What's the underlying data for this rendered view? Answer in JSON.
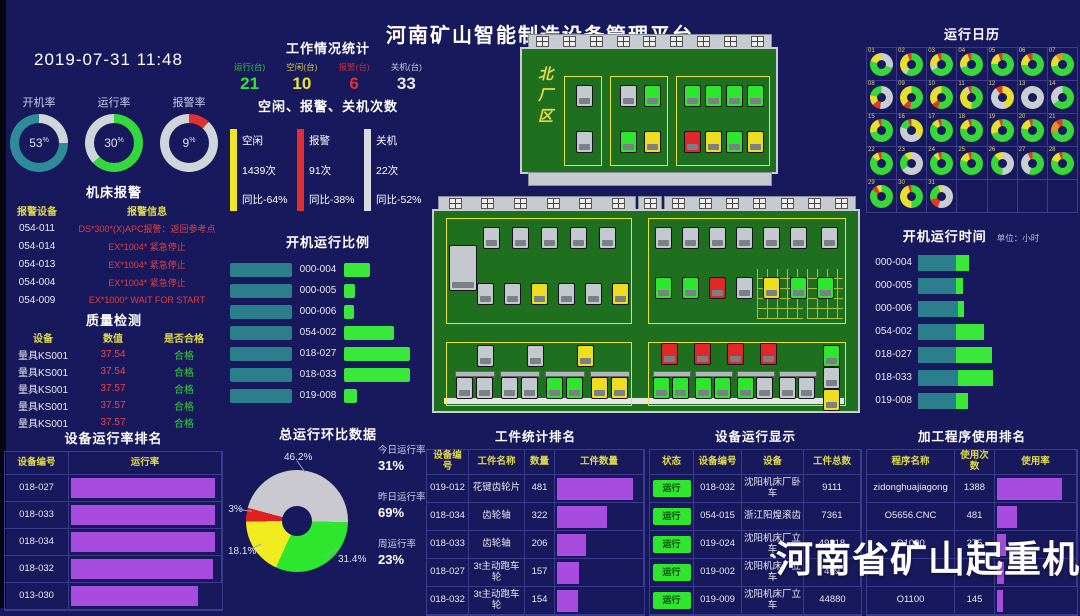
{
  "title": "河南矿山智能制造设备管理平台",
  "datetime": "2019-07-31 11:48",
  "gauges": {
    "items": [
      {
        "label": "开机率",
        "value": "53",
        "unit": "%",
        "c1": "#cfd6da",
        "p1": 25,
        "c2": "#2d8c98"
      },
      {
        "label": "运行率",
        "value": "30",
        "unit": "%",
        "c1": "#35d83c",
        "p1": 63,
        "c2": "#cfd6da"
      },
      {
        "label": "报警率",
        "value": "9",
        "unit": "%",
        "c1": "#e03030",
        "p1": 12,
        "c2": "#cfd6da"
      }
    ]
  },
  "alarm": {
    "title": "机床报警",
    "headers": [
      "报警设备",
      "报警信息"
    ],
    "rows": [
      {
        "dev": "054-011",
        "msg": "DS*300*(X)APC报警：返回参考点"
      },
      {
        "dev": "054-014",
        "msg": "EX*1004* 紧急停止"
      },
      {
        "dev": "054-013",
        "msg": "EX*1004* 紧急停止"
      },
      {
        "dev": "054-004",
        "msg": "EX*1004* 紧急停止"
      },
      {
        "dev": "054-009",
        "msg": "EX*1000* WAIT FOR START"
      }
    ]
  },
  "quality": {
    "title": "质量检测",
    "headers": [
      "设备",
      "数值",
      "是否合格"
    ],
    "rows": [
      {
        "dev": "量具KS001",
        "val": "37.54",
        "ok": "合格"
      },
      {
        "dev": "量具KS001",
        "val": "37.54",
        "ok": "合格"
      },
      {
        "dev": "量具KS001",
        "val": "37.57",
        "ok": "合格"
      },
      {
        "dev": "量具KS001",
        "val": "37.57",
        "ok": "合格"
      },
      {
        "dev": "量具KS001",
        "val": "37.57",
        "ok": "合格"
      }
    ]
  },
  "rank": {
    "title": "设备运行率排名",
    "headers": [
      "设备编号",
      "运行率"
    ],
    "rows": [
      {
        "id": "018-027",
        "pct": 97
      },
      {
        "id": "018-033",
        "pct": 97
      },
      {
        "id": "018-034",
        "pct": 97
      },
      {
        "id": "018-032",
        "pct": 96
      },
      {
        "id": "013-030",
        "pct": 85
      }
    ]
  },
  "workstats": {
    "title": "工作情况统计",
    "items": [
      {
        "label": "运行(台)",
        "value": "21",
        "color": "#2fe32f"
      },
      {
        "label": "空闲(台)",
        "value": "10",
        "color": "#ece23a"
      },
      {
        "label": "报警(台)",
        "value": "6",
        "color": "#e03030"
      },
      {
        "label": "关机(台)",
        "value": "33",
        "color": "#e8e8f0"
      }
    ]
  },
  "counts": {
    "title": "空闲、报警、关机次数",
    "items": [
      {
        "label": "空闲",
        "count": "1439次",
        "yoy": "同比-64%",
        "color": "#f0e626"
      },
      {
        "label": "报警",
        "count": "91次",
        "yoy": "同比-38%",
        "color": "#e03030"
      },
      {
        "label": "关机",
        "count": "22次",
        "yoy": "同比-52%",
        "color": "#d8dce2"
      }
    ]
  },
  "ratio": {
    "title": "开机运行比例",
    "rows": [
      {
        "id": "000-004",
        "green": 26
      },
      {
        "id": "000-005",
        "green": 11
      },
      {
        "id": "000-006",
        "green": 10
      },
      {
        "id": "054-002",
        "green": 50
      },
      {
        "id": "018-027",
        "green": 66
      },
      {
        "id": "018-033",
        "green": 66
      },
      {
        "id": "019-008",
        "green": 13
      }
    ]
  },
  "pie": {
    "title": "总运行环比数据",
    "slices": [
      {
        "label": "46.2%",
        "pct": 46.2,
        "color": "#c9c9cf"
      },
      {
        "label": "31.4%",
        "pct": 31.4,
        "color": "#2ee62e"
      },
      {
        "label": "18.1%",
        "pct": 18.1,
        "color": "#f0ec20"
      },
      {
        "label": "4.3%",
        "pct": 4.3,
        "color": "#e02020"
      }
    ],
    "side": [
      {
        "label": "今日运行率",
        "value": "31%"
      },
      {
        "label": "昨日运行率",
        "value": "69%"
      },
      {
        "label": "周运行率",
        "value": "23%"
      }
    ]
  },
  "factory": {
    "status_colors": {
      "g": "#c3c9cf",
      "G": "#2ee62e",
      "Y": "#f0dc20",
      "R": "#e02828"
    },
    "north": {
      "label": "北厂区",
      "zones": [
        {
          "x": 44,
          "y": 42,
          "w": 36,
          "h": 88,
          "cols": 1,
          "m": [
            "g",
            "g"
          ]
        },
        {
          "x": 90,
          "y": 42,
          "w": 56,
          "h": 88,
          "cols": 2,
          "m": [
            "g",
            "G",
            "G",
            "Y"
          ]
        },
        {
          "x": 156,
          "y": 42,
          "w": 92,
          "h": 88,
          "cols": 4,
          "m": [
            "G",
            "G",
            "G",
            "G",
            "R",
            "Y",
            "G",
            "Y"
          ]
        }
      ]
    },
    "south": {
      "lt_row1": [
        "g",
        "g",
        "g",
        "g",
        "g"
      ],
      "lt_row2": [
        "g",
        "g",
        "Y",
        "g",
        "g",
        "Y"
      ],
      "rt_row1": [
        "g",
        "g",
        "g",
        "g",
        "g",
        "g"
      ],
      "rt_row2": [
        "G",
        "G",
        "R",
        "g",
        "Y",
        "G",
        "G"
      ],
      "lb_top": [
        "g",
        "g",
        "Y"
      ],
      "lb_st": [
        [
          "g",
          "g"
        ],
        [
          "g",
          "g"
        ],
        [
          "G",
          "G"
        ],
        [
          "Y",
          "Y"
        ]
      ],
      "rb_top": [
        "R",
        "R",
        "R",
        "R"
      ],
      "rb_st": [
        [
          "G",
          "G"
        ],
        [
          "G",
          "G"
        ],
        [
          "G",
          "g"
        ],
        [
          "g",
          "g"
        ]
      ],
      "rb_side": [
        "G",
        "g",
        "Y"
      ]
    }
  },
  "calendar": {
    "title": "运行日历",
    "colors": {
      "G": "#38d838",
      "Y": "#e8de2e",
      "N": "#c9ced3",
      "R": "#e03a22",
      "O": "#e8901e"
    },
    "days": [
      {
        "d": "01",
        "s": [
          [
            "N",
            30
          ],
          [
            "G",
            50
          ],
          [
            "Y",
            20
          ]
        ]
      },
      {
        "d": "02",
        "s": [
          [
            "G",
            58
          ],
          [
            "N",
            6
          ],
          [
            "Y",
            30
          ],
          [
            "R",
            6
          ]
        ]
      },
      {
        "d": "03",
        "s": [
          [
            "G",
            66
          ],
          [
            "N",
            8
          ],
          [
            "Y",
            20
          ],
          [
            "R",
            6
          ]
        ]
      },
      {
        "d": "04",
        "s": [
          [
            "G",
            70
          ],
          [
            "N",
            4
          ],
          [
            "Y",
            20
          ],
          [
            "R",
            6
          ]
        ]
      },
      {
        "d": "05",
        "s": [
          [
            "G",
            76
          ],
          [
            "Y",
            18
          ],
          [
            "R",
            6
          ]
        ]
      },
      {
        "d": "06",
        "s": [
          [
            "G",
            74
          ],
          [
            "Y",
            18
          ],
          [
            "R",
            8
          ]
        ]
      },
      {
        "d": "07",
        "s": [
          [
            "G",
            72
          ],
          [
            "Y",
            18
          ],
          [
            "O",
            10
          ]
        ]
      },
      {
        "d": "08",
        "s": [
          [
            "N",
            52
          ],
          [
            "R",
            12
          ],
          [
            "Y",
            14
          ],
          [
            "G",
            22
          ]
        ]
      },
      {
        "d": "09",
        "s": [
          [
            "G",
            52
          ],
          [
            "R",
            10
          ],
          [
            "Y",
            38
          ]
        ]
      },
      {
        "d": "10",
        "s": [
          [
            "G",
            55
          ],
          [
            "R",
            10
          ],
          [
            "Y",
            35
          ]
        ]
      },
      {
        "d": "11",
        "s": [
          [
            "G",
            50
          ],
          [
            "Y",
            40
          ],
          [
            "N",
            5
          ],
          [
            "R",
            5
          ]
        ]
      },
      {
        "d": "12",
        "s": [
          [
            "Y",
            45
          ],
          [
            "N",
            45
          ],
          [
            "R",
            10
          ]
        ]
      },
      {
        "d": "13",
        "s": [
          [
            "N",
            100
          ]
        ]
      },
      {
        "d": "14",
        "s": [
          [
            "G",
            65
          ],
          [
            "N",
            35
          ]
        ]
      },
      {
        "d": "15",
        "s": [
          [
            "G",
            72
          ],
          [
            "Y",
            23
          ],
          [
            "R",
            5
          ]
        ]
      },
      {
        "d": "16",
        "s": [
          [
            "Y",
            35
          ],
          [
            "N",
            45
          ],
          [
            "G",
            15
          ],
          [
            "R",
            5
          ]
        ]
      },
      {
        "d": "17",
        "s": [
          [
            "G",
            85
          ],
          [
            "Y",
            10
          ],
          [
            "R",
            5
          ]
        ]
      },
      {
        "d": "18",
        "s": [
          [
            "G",
            78
          ],
          [
            "Y",
            17
          ],
          [
            "R",
            5
          ]
        ]
      },
      {
        "d": "19",
        "s": [
          [
            "G",
            70
          ],
          [
            "Y",
            25
          ],
          [
            "R",
            5
          ]
        ]
      },
      {
        "d": "20",
        "s": [
          [
            "G",
            78
          ],
          [
            "Y",
            17
          ],
          [
            "R",
            5
          ]
        ]
      },
      {
        "d": "21",
        "s": [
          [
            "G",
            72
          ],
          [
            "O",
            18
          ],
          [
            "R",
            10
          ]
        ]
      },
      {
        "d": "22",
        "s": [
          [
            "G",
            85
          ],
          [
            "Y",
            10
          ],
          [
            "R",
            5
          ]
        ]
      },
      {
        "d": "23",
        "s": [
          [
            "N",
            65
          ],
          [
            "G",
            25
          ],
          [
            "Y",
            10
          ]
        ]
      },
      {
        "d": "24",
        "s": [
          [
            "G",
            88
          ],
          [
            "Y",
            7
          ],
          [
            "R",
            5
          ]
        ]
      },
      {
        "d": "25",
        "s": [
          [
            "G",
            80
          ],
          [
            "Y",
            15
          ],
          [
            "R",
            5
          ]
        ]
      },
      {
        "d": "26",
        "s": [
          [
            "N",
            50
          ],
          [
            "G",
            38
          ],
          [
            "Y",
            12
          ]
        ]
      },
      {
        "d": "27",
        "s": [
          [
            "G",
            55
          ],
          [
            "N",
            38
          ],
          [
            "R",
            7
          ]
        ]
      },
      {
        "d": "28",
        "s": [
          [
            "G",
            80
          ],
          [
            "Y",
            15
          ],
          [
            "R",
            5
          ]
        ]
      },
      {
        "d": "29",
        "s": [
          [
            "G",
            85
          ],
          [
            "R",
            8
          ],
          [
            "Y",
            7
          ]
        ]
      },
      {
        "d": "30",
        "s": [
          [
            "G",
            50
          ],
          [
            "Y",
            45
          ],
          [
            "R",
            5
          ]
        ]
      },
      {
        "d": "31",
        "s": [
          [
            "N",
            55
          ],
          [
            "R",
            15
          ],
          [
            "G",
            25
          ],
          [
            "Y",
            5
          ]
        ]
      }
    ]
  },
  "runtime": {
    "title": "开机运行时间",
    "unit": "单位：小时",
    "rows": [
      {
        "id": "000-004",
        "teal": 38,
        "green": 13
      },
      {
        "id": "000-005",
        "teal": 38,
        "green": 7
      },
      {
        "id": "000-006",
        "teal": 40,
        "green": 6
      },
      {
        "id": "054-002",
        "teal": 38,
        "green": 28
      },
      {
        "id": "018-027",
        "teal": 38,
        "green": 36
      },
      {
        "id": "018-033",
        "teal": 40,
        "green": 35
      },
      {
        "id": "019-008",
        "teal": 38,
        "green": 12
      }
    ]
  },
  "workpiece": {
    "title": "工件统计排名",
    "headers": [
      "设备编号",
      "工件名称",
      "数量",
      "工件数量"
    ],
    "rows": [
      {
        "id": "019-012",
        "name": "花键齿轮片",
        "qty": "481",
        "pct": 90
      },
      {
        "id": "018-034",
        "name": "齿轮轴",
        "qty": "322",
        "pct": 60
      },
      {
        "id": "018-033",
        "name": "齿轮轴",
        "qty": "206",
        "pct": 35
      },
      {
        "id": "018-027",
        "name": "3t主动跑车轮",
        "qty": "157",
        "pct": 26
      },
      {
        "id": "018-032",
        "name": "3t主动跑车轮",
        "qty": "154",
        "pct": 25
      }
    ]
  },
  "device": {
    "title": "设备运行显示",
    "headers": [
      "状态",
      "设备编号",
      "设备",
      "工件总数"
    ],
    "rows": [
      {
        "status": "运行",
        "id": "018-032",
        "name": "沈阳机床厂卧车",
        "total": "9111"
      },
      {
        "status": "运行",
        "id": "054-015",
        "name": "浙江阳煌滚齿",
        "total": "7361"
      },
      {
        "status": "运行",
        "id": "019-024",
        "name": "沈阳机床厂立车",
        "total": "49318"
      },
      {
        "status": "运行",
        "id": "019-002",
        "name": "沈阳机床厂立车",
        "total": "469"
      },
      {
        "status": "运行",
        "id": "019-009",
        "name": "沈阳机床厂立车",
        "total": "44880"
      }
    ]
  },
  "program": {
    "title": "加工程序使用排名",
    "headers": [
      "程序名称",
      "使用次数",
      "使用率"
    ],
    "rows": [
      {
        "name": "zidonghuajiagong",
        "uses": "1388",
        "pct": 85
      },
      {
        "name": "O5656.CNC",
        "uses": "481",
        "pct": 26
      },
      {
        "name": "O1000",
        "uses": "275",
        "pct": 12
      },
      {
        "name": "",
        "uses": "",
        "pct": 9
      },
      {
        "name": "O1100",
        "uses": "145",
        "pct": 8
      }
    ]
  },
  "watermark": {
    "text": "河南省矿山起重机"
  }
}
